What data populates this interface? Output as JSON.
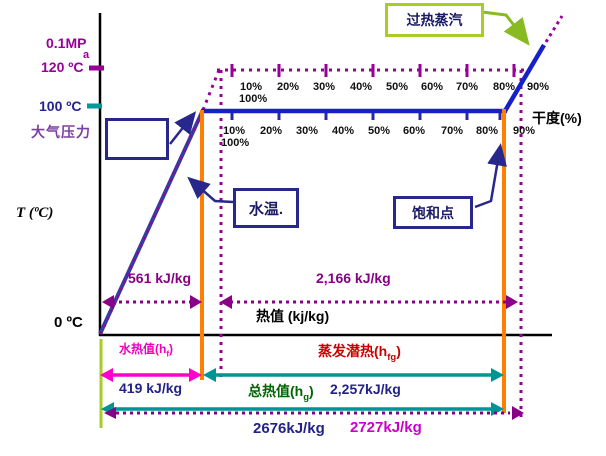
{
  "colors": {
    "magenta_label": "#990099",
    "purple_dotted": "#880088",
    "navy_text": "#222288",
    "blue_line": "#1520C8",
    "diagonal_line": "#3A3A9E",
    "orange_line": "#FF8000",
    "teal_arrow": "#009494",
    "pink_arrow": "#FF00CC",
    "red_label": "#CC0000",
    "green_label": "#006600",
    "yellow_green": "#A8CC28",
    "box_border": "#28288C",
    "axis_black": "#000000"
  },
  "y_axis": {
    "pressure": "0.1MP",
    "pressure_sub": "a",
    "t_120": "120 ºC",
    "t_100": "100 ºC",
    "atmospheric_pressure": "大气压力",
    "axis_title": "T (ºC)",
    "origin": "0 ºC"
  },
  "x_axis": {
    "title": "热值 (kj/kg)"
  },
  "dryness": {
    "axis_label": "干度(%)",
    "upper_row": [
      "10%",
      "20%",
      "30%",
      "40%",
      "50%",
      "60%",
      "70%",
      "80%",
      "90%"
    ],
    "upper_100": "100%",
    "lower_row": [
      "10%",
      "20%",
      "30%",
      "40%",
      "50%",
      "60%",
      "70%",
      "80%",
      "90%"
    ],
    "lower_100": "100%"
  },
  "callouts": {
    "superheated_steam": "过热蒸汽",
    "water_temperature": "水温.",
    "saturation_point": "饱和点"
  },
  "enthalpy": {
    "sensible_120": "561 kJ/kg",
    "latent_120": "2,166 kJ/kg",
    "water_heat_label": {
      "pre": "水热值(h",
      "sub": "f",
      "post": ")"
    },
    "sensible_100": "419 kJ/kg",
    "latent_label": {
      "pre": "蒸发潜热(h",
      "sub": "fg",
      "post": ")"
    },
    "latent_100": "2,257kJ/kg",
    "total_label": {
      "pre": "总热值(h",
      "sub": "g",
      "post": ")"
    },
    "total_100": "2676kJ/kg",
    "total_120": "2727kJ/kg"
  }
}
